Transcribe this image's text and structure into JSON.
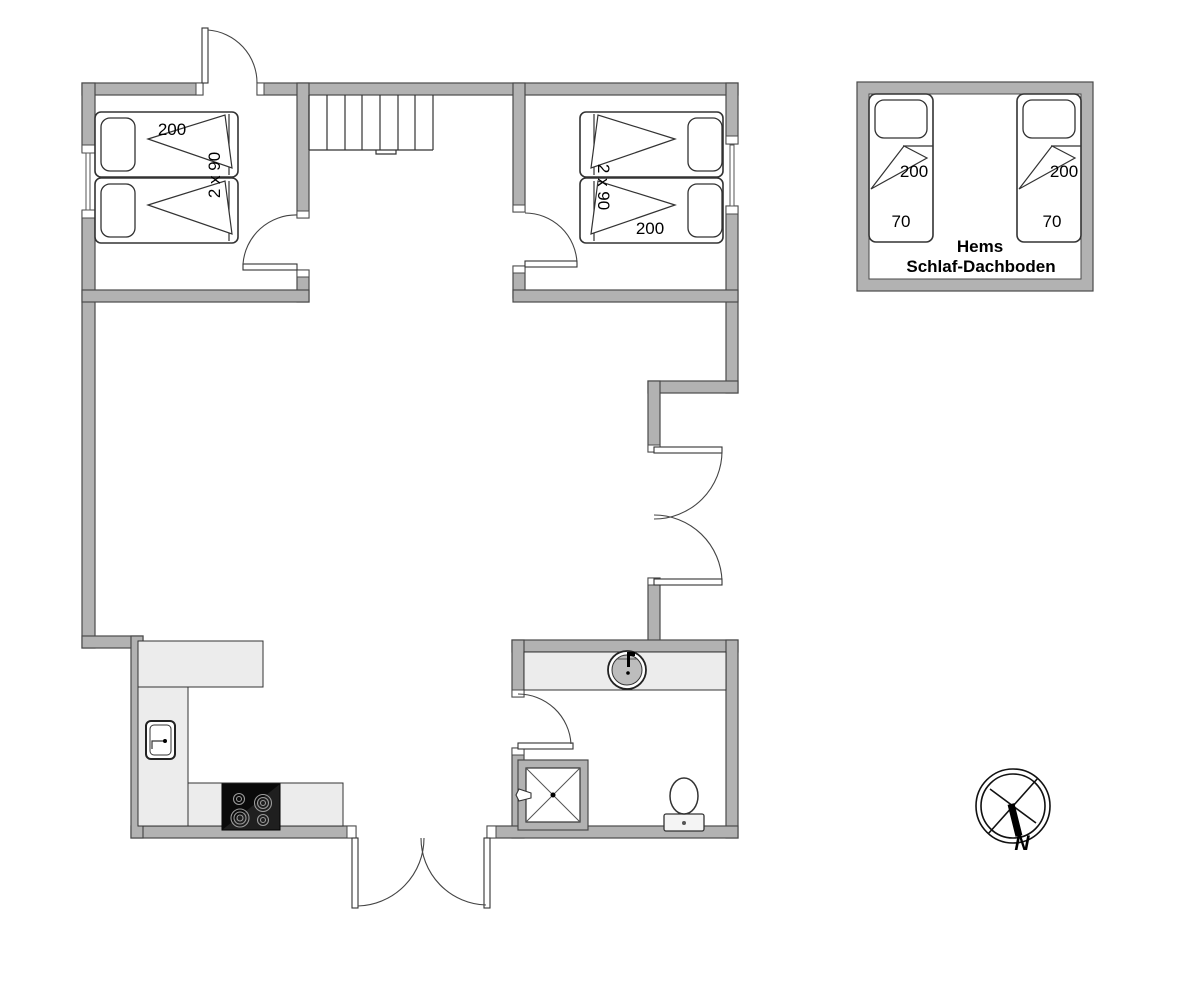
{
  "plan": {
    "bedroom_left": {
      "bed_length": "200",
      "bed_size": "2 x 90"
    },
    "bedroom_right": {
      "bed_size": "2 x 90",
      "bed_length": "200"
    },
    "hems": {
      "name_line1": "Hems",
      "name_line2": "Schlaf-Dachboden",
      "bed_left": {
        "length": "200",
        "width": "70"
      },
      "bed_right": {
        "length": "200",
        "width": "70"
      }
    },
    "compass": {
      "north": "N"
    },
    "colors": {
      "wall_fill": "#b2b2b2",
      "wall_stroke": "#4a4a4a",
      "line": "#333333",
      "counter_fill": "#ececec",
      "stove_fill": "#141414",
      "background": "#ffffff"
    }
  }
}
